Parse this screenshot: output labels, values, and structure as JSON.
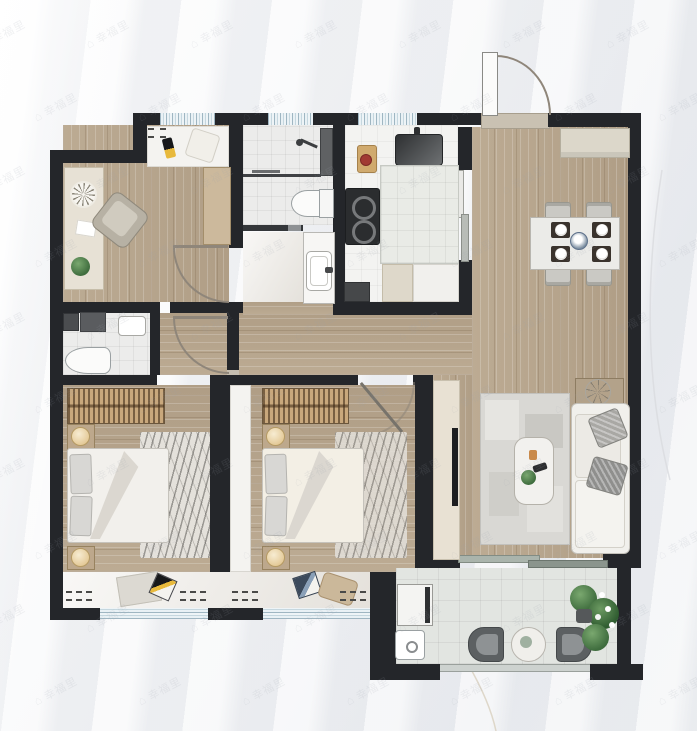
{
  "document": {
    "kind": "real-estate floor plan rendering",
    "visible_text_other_than_watermark": ""
  },
  "watermark": {
    "text": "幸福里",
    "icon": "house-icon",
    "icon_glyph": "⌂",
    "color": "#9aa0ab",
    "opacity": 0.14,
    "rotation_deg": -28,
    "grid": {
      "rows": 10,
      "cols": 7,
      "x_start": -20,
      "y_start": 26,
      "x_step": 104,
      "y_step": 73,
      "row_offset": 52
    }
  },
  "palette": {
    "wall": "#24262a",
    "wood_floor": "#b7a58d",
    "tile_floor": "#ececeb",
    "kitchen_floor": "#f3f3f1",
    "marble_floor": "#edeae5",
    "balcony_tile": "#e2e5e1",
    "window_glazing": "#d5e3ea",
    "wardrobe_wood": "#c9a87c",
    "sofa_fabric": "#f1f0ec",
    "plant_green": "#4d7c4b",
    "background_fabric": "#eef0f3",
    "door_arc": "#8f867a"
  },
  "rooms": [
    {
      "id": "study",
      "furniture": [
        "desk",
        "desk-clock",
        "paper",
        "potted-plant",
        "office-chair",
        "side-cabinet",
        "window-bench",
        "bench-pillows"
      ]
    },
    {
      "id": "bathroom",
      "furniture": [
        "shower-head",
        "glass-panel",
        "toilet",
        "partition-slider"
      ]
    },
    {
      "id": "wash-area",
      "furniture": [
        "vanity-counter",
        "wash-basin"
      ]
    },
    {
      "id": "kitchen",
      "furniture": [
        "sink",
        "cutting-board",
        "cooktop-two-burners",
        "island-counter",
        "floor-mats",
        "appliance"
      ]
    },
    {
      "id": "entry-dining",
      "furniture": [
        "entry-door",
        "shoe-sideboard",
        "dining-table",
        "four-chairs",
        "four-place-settings",
        "centerpiece"
      ]
    },
    {
      "id": "hallway",
      "furniture": [
        "swing-door-1",
        "swing-door-2"
      ]
    },
    {
      "id": "master-bathroom",
      "furniture": [
        "storage-cabinets",
        "wash-basin",
        "toilet"
      ]
    },
    {
      "id": "bedroom-1",
      "furniture": [
        "wardrobe",
        "nightstand-with-lamp-x2",
        "double-bed",
        "marble-throw",
        "rug",
        "magazines",
        "window"
      ]
    },
    {
      "id": "bedroom-2",
      "furniture": [
        "slim-cabinet",
        "wardrobe",
        "nightstand-with-lamp-x2",
        "double-bed",
        "marble-throw",
        "magazines",
        "floor-pillow",
        "window"
      ]
    },
    {
      "id": "living-room",
      "furniture": [
        "tv-cabinet",
        "tv",
        "area-rug",
        "coffee-table",
        "sofa",
        "throw-pillows",
        "side-table-with-plant",
        "sliding-balcony-door"
      ]
    },
    {
      "id": "balcony",
      "furniture": [
        "washing-machine",
        "utility-sink",
        "lounge-chair-x2",
        "round-table",
        "plant-cluster"
      ]
    }
  ]
}
